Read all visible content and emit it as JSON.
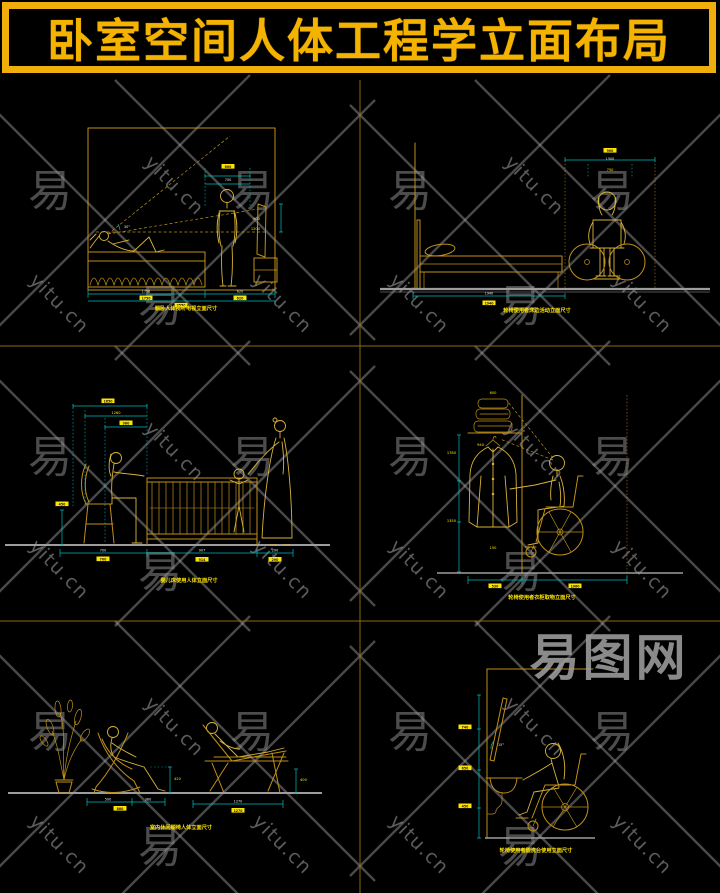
{
  "header": {
    "title": "卧室空间人体工程学立面布局",
    "border_color": "#efae0c",
    "title_color": "#f5b301"
  },
  "watermark": {
    "site": "yitu.cn",
    "logo": "易",
    "brand": "易图网"
  },
  "colors": {
    "background": "#000000",
    "cad_gold": "#c19018",
    "figure_gold": "#d9b33a",
    "dimension_cyan": "#00bcbc",
    "label_yellow": "#ffe400",
    "floor_gray": "#9d9d9d",
    "watermark_gray": "#8f8f8f",
    "divider_olive": "#8a6a12"
  },
  "panels": [
    {
      "id": "bed-tv-viewing",
      "caption": "躺卧人体视听电视立面尺寸",
      "labels": [
        "600",
        "700",
        "900",
        "1200",
        "1750",
        "620",
        "1750",
        "620",
        "2550",
        "30°"
      ]
    },
    {
      "id": "wheelchair-bedside",
      "caption": "轮椅使用者床边活动立面尺寸",
      "labels": [
        "900",
        "1500",
        "750",
        "1940",
        "1940"
      ]
    },
    {
      "id": "baby-crib",
      "caption": "婴儿床使用人体立面尺寸",
      "labels": [
        "1650",
        "1260",
        "960",
        "450",
        "700",
        "907",
        "290",
        "700",
        "914",
        "290"
      ]
    },
    {
      "id": "wheelchair-wardrobe",
      "caption": "轮椅使用者衣柜取物立面尺寸",
      "labels": [
        "600",
        "1780",
        "1350",
        "940",
        "150",
        "530",
        "1060"
      ]
    },
    {
      "id": "lounge-chairs",
      "caption": "室内休闲躺椅人体立面尺寸",
      "labels": [
        "500",
        "380",
        "880",
        "1270",
        "1270",
        "420",
        "400"
      ]
    },
    {
      "id": "wheelchair-washbasin",
      "caption": "轮椅使用者盥洗台使用立面尺寸",
      "labels": [
        "740",
        "650",
        "450",
        "15°"
      ]
    }
  ]
}
